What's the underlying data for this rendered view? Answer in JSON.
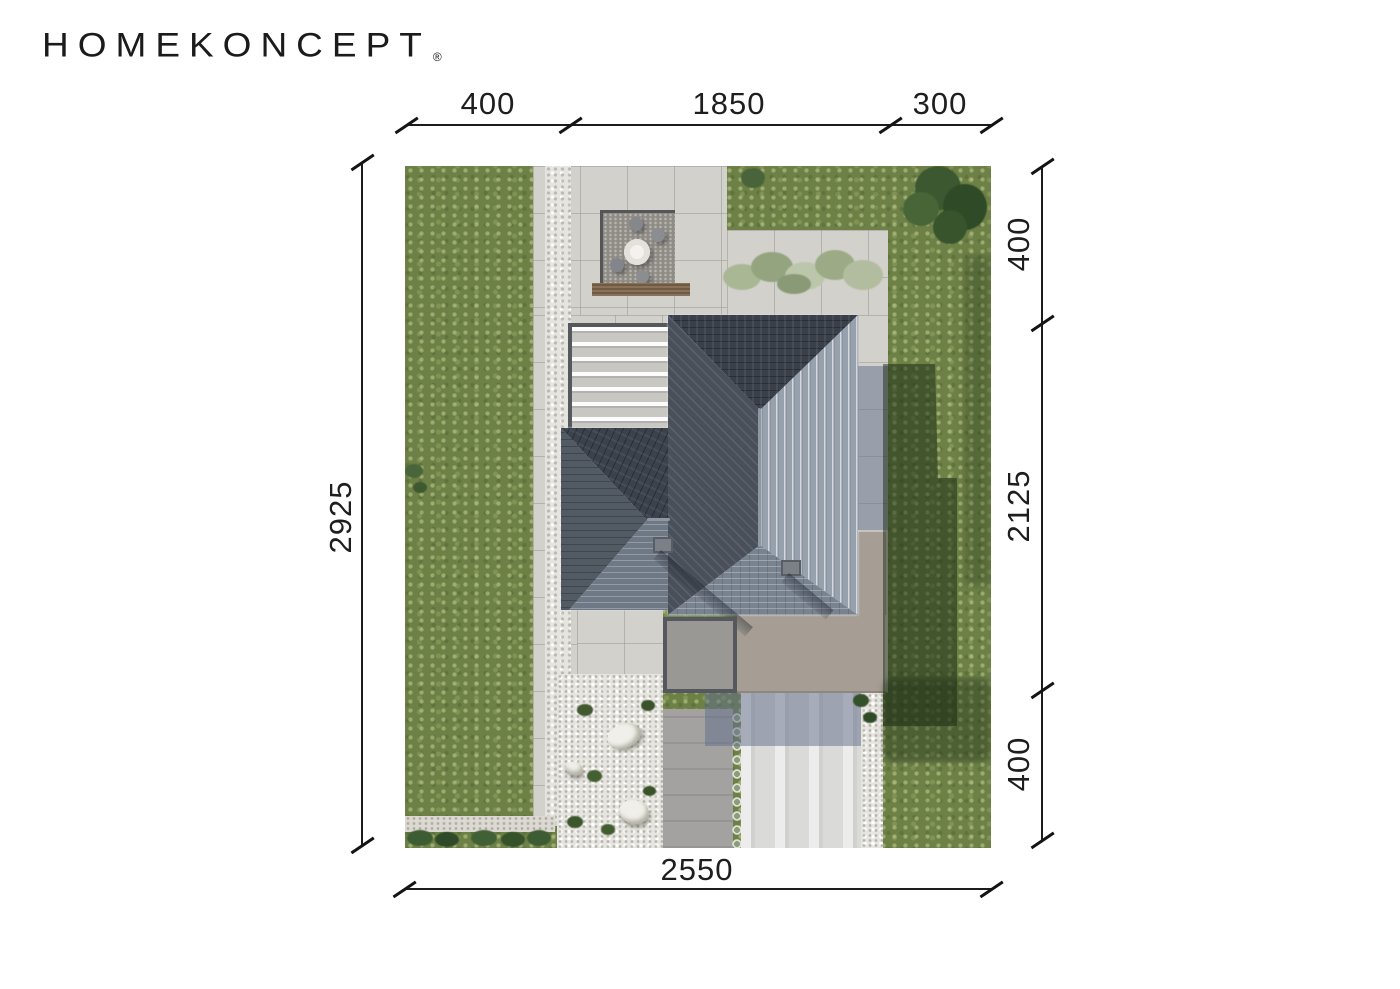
{
  "logo": {
    "brand": "HOMEKONCEPT",
    "registered": "®"
  },
  "dimensions": {
    "top": {
      "segments": [
        "400",
        "1850",
        "300"
      ]
    },
    "right": {
      "segments": [
        "400",
        "2125",
        "400"
      ]
    },
    "left": {
      "total": "2925"
    },
    "bottom": {
      "total": "2550"
    }
  },
  "site_plan": {
    "type": "aerial-site-plan-render",
    "colors": {
      "grass": "#6d8147",
      "paving": "#d3d1cc",
      "white_gravel": "#e7e5df",
      "roof_dark": "#394049",
      "roof_lit": "#97a1ae",
      "roof_medium": "#79828f",
      "flat_roof": "#a69e94",
      "driveway": "#dadad8",
      "shadow_on_grass": "#27401f",
      "dimension_ink": "#1c1c1c"
    }
  }
}
